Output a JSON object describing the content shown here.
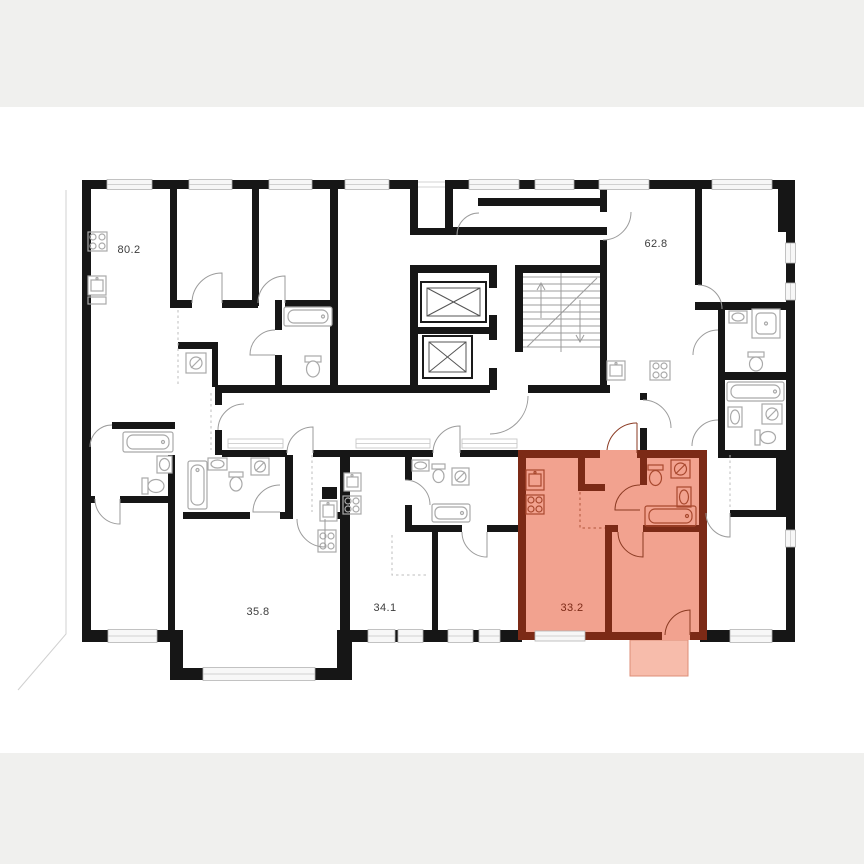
{
  "page": {
    "background": "#ffffff",
    "letterbox_color": "#f0f0ee"
  },
  "floorplan": {
    "type": "residential-floor-plan",
    "apartments": [
      {
        "id": "apt-1",
        "area_label": "80.2",
        "highlighted": false
      },
      {
        "id": "apt-2",
        "area_label": "62.8",
        "highlighted": false
      },
      {
        "id": "apt-3",
        "area_label": "35.8",
        "highlighted": false
      },
      {
        "id": "apt-4",
        "area_label": "34.1",
        "highlighted": false
      },
      {
        "id": "apt-5",
        "area_label": "33.2",
        "highlighted": true
      }
    ],
    "highlight": {
      "fill": "#f2a28f",
      "wall": "#7c2a16",
      "balcony_fill": "#f7bcab",
      "balcony_border": "#dd8e77",
      "label_color": "#7c2a16"
    },
    "colors": {
      "walls": "#161616",
      "fixtures": "#a9a9a9",
      "doors": "#9b9b9b",
      "text": "#3d3d3d",
      "window": "#b3b3b3"
    },
    "core": {
      "elevators": 2,
      "stairs": 1
    },
    "icons": [
      "stove-icon",
      "kitchen-sink-icon",
      "bathtub-icon",
      "toilet-icon",
      "washing-machine-icon",
      "bathroom-sink-icon",
      "shower-icon",
      "elevator-icon",
      "stairs-icon",
      "door-arc-icon",
      "window-icon"
    ]
  }
}
